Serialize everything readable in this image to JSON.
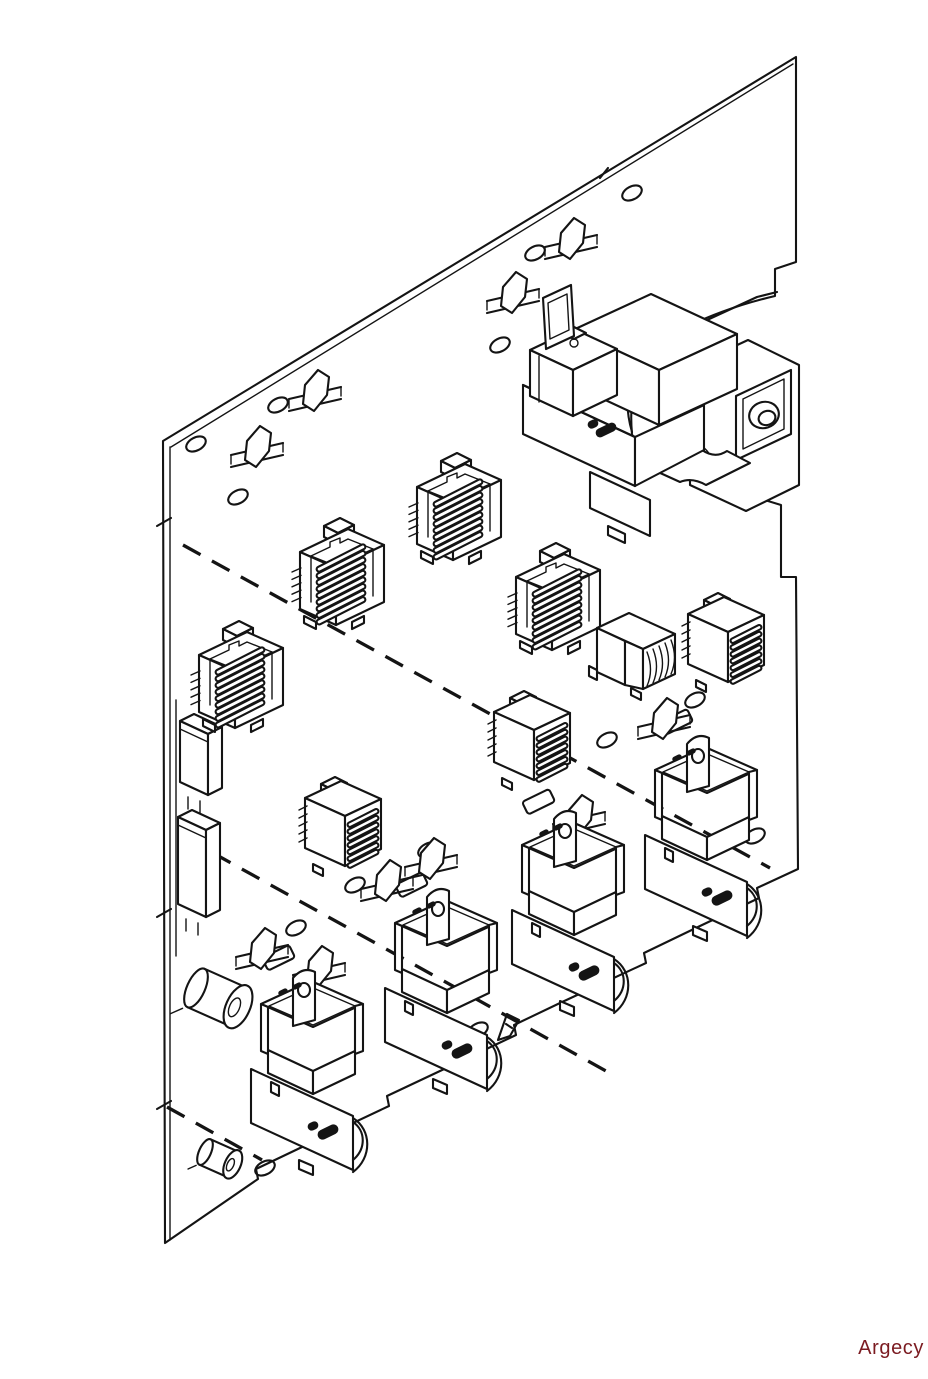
{
  "page": {
    "width": 928,
    "height": 1379,
    "background": "#ffffff"
  },
  "watermark": {
    "text": "Argecy",
    "color": "#7b1b21"
  },
  "diagram": {
    "name": "printer-power-supply-board-isometric-line-drawing",
    "stroke": "#141414",
    "board": {
      "outline_path": "M163,441 L796,57 L796,262 L775,269 L775,296 C745,303 700,317 668,338 C640,352 628,390 632,434 L640,462 L781,505 L781,577 L796,577 L798,869 L757,888 L759,898 L700,926 L644,953 L646,963 L560,1003 L514,1025 L516,1035 L440,1071 L387,1096 L389,1106 L300,1148 L256,1169 L258,1179 L165,1243 Z",
      "inner_top": [
        171,
        447,
        793,
        64
      ],
      "inner_left": [
        170,
        447,
        170,
        1240
      ],
      "edge_strip": [
        176,
        700,
        176,
        956
      ],
      "ticks": [
        [
          157,
          526,
          171,
          518
        ],
        [
          157,
          917,
          171,
          909
        ],
        [
          157,
          1109,
          171,
          1101
        ],
        [
          600,
          178,
          608,
          168
        ]
      ]
    },
    "dashed_lines": [
      [
        183,
        545,
        770,
        868
      ],
      [
        213,
        853,
        615,
        1076
      ],
      [
        167,
        1107,
        262,
        1160
      ]
    ],
    "holes": [
      [
        196,
        444
      ],
      [
        238,
        497
      ],
      [
        278,
        405
      ],
      [
        632,
        193
      ],
      [
        535,
        253
      ],
      [
        500,
        345
      ],
      [
        355,
        885
      ],
      [
        296,
        928
      ],
      [
        428,
        850
      ],
      [
        695,
        700
      ],
      [
        607,
        740
      ],
      [
        755,
        836
      ],
      [
        478,
        1030
      ],
      [
        265,
        1168
      ]
    ],
    "jumpers": [
      [
        296,
        368
      ],
      [
        238,
        424
      ],
      [
        552,
        216
      ],
      [
        494,
        270
      ],
      [
        645,
        696
      ],
      [
        560,
        793
      ],
      [
        368,
        858
      ],
      [
        243,
        926
      ],
      [
        300,
        944
      ],
      [
        412,
        836
      ]
    ],
    "pads": [
      [
        262,
        958
      ],
      [
        395,
        885
      ],
      [
        522,
        802
      ],
      [
        660,
        722
      ]
    ],
    "coils": [
      {
        "type": "angled",
        "x": 296,
        "y": 512
      },
      {
        "type": "angled",
        "x": 413,
        "y": 447
      },
      {
        "type": "angled",
        "x": 512,
        "y": 537
      },
      {
        "type": "angled",
        "x": 195,
        "y": 615
      },
      {
        "type": "barrel",
        "x": 597,
        "y": 610
      },
      {
        "type": "front",
        "x": 688,
        "y": 592
      },
      {
        "type": "front",
        "x": 494,
        "y": 690
      },
      {
        "type": "front",
        "x": 305,
        "y": 776
      }
    ],
    "relays": [
      [
        253,
        974
      ],
      [
        387,
        893
      ],
      [
        514,
        815
      ],
      [
        647,
        740
      ]
    ],
    "modules": [
      [
        180,
        712,
        70
      ],
      [
        178,
        808,
        96
      ]
    ],
    "capacitors": [
      [
        196,
        988,
        1
      ],
      [
        205,
        1152,
        0.66
      ]
    ],
    "transformer": [
      505,
      272
    ],
    "flag": [
      498,
      1012
    ]
  }
}
